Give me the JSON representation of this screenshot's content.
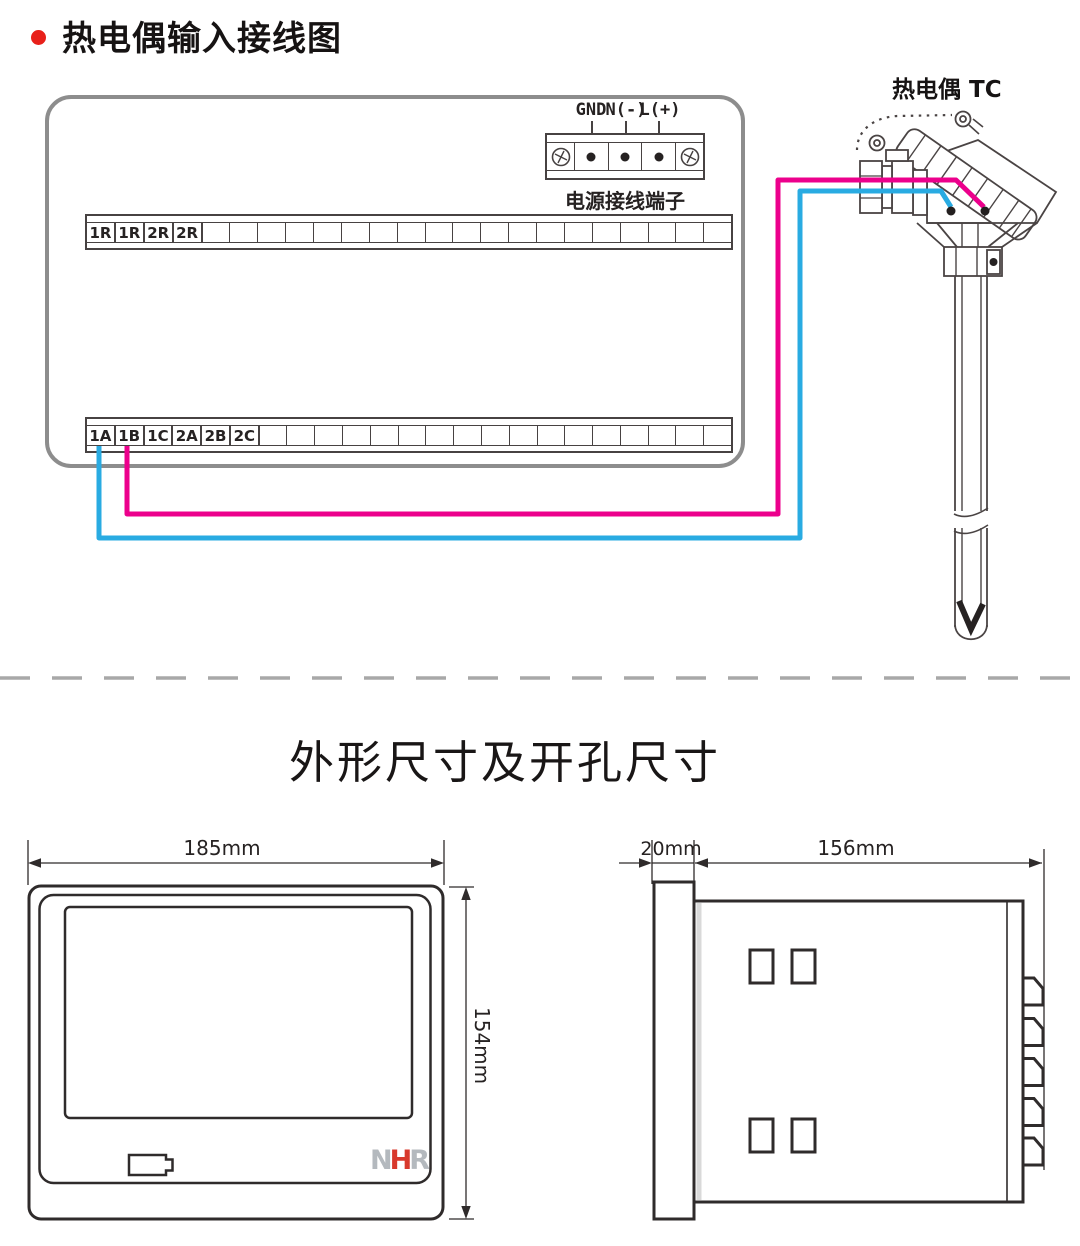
{
  "wiring": {
    "bullet_color": "#e8201a",
    "title": "热电偶输入接线图",
    "tc_label": "热电偶 TC",
    "power": {
      "labels": [
        "GND",
        "N(-)",
        "L(+)"
      ],
      "caption": "电源接线端子"
    },
    "upper_strip": {
      "labels": [
        "1R",
        "1R",
        "2R",
        "2R"
      ],
      "empty_cells": 19
    },
    "lower_strip": {
      "labels": [
        "1A",
        "1B",
        "1C",
        "2A",
        "2B",
        "2C"
      ],
      "empty_cells": 17
    },
    "colors": {
      "wire_blue": "#29abe2",
      "wire_pink": "#ec008c",
      "device_outline": "#8d8d8d",
      "line_dark": "#4a4444"
    }
  },
  "dimensions": {
    "title": "外形尺寸及开孔尺寸",
    "front": {
      "width": "185mm",
      "height": "154mm",
      "logo": [
        "N",
        "H",
        "R"
      ],
      "logo_colors": [
        "#b4b9be",
        "#d8392c",
        "#b4b9be"
      ]
    },
    "side": {
      "depth": "20mm",
      "body": "156mm"
    }
  }
}
